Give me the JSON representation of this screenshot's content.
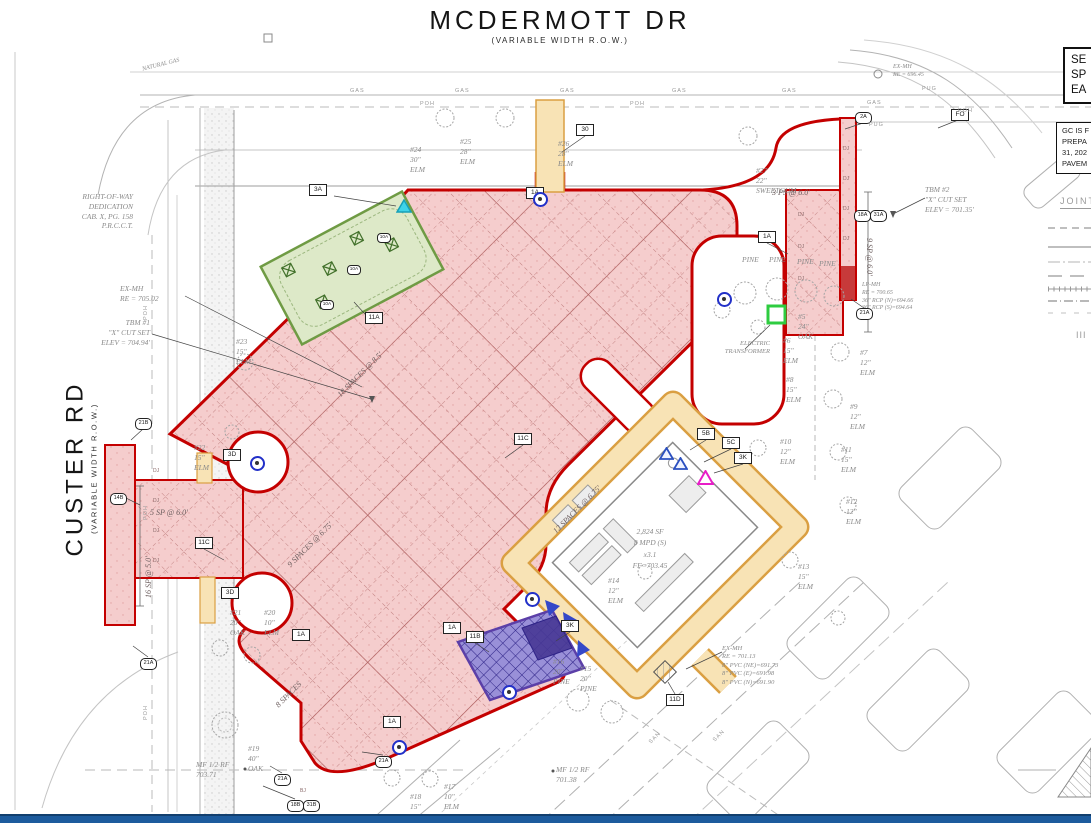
{
  "roads": {
    "top_name": "MCDERMOTT DR",
    "top_row": "(VARIABLE WIDTH R.O.W.)",
    "left_name": "CUSTER RD",
    "left_row": "(VARIABLE WIDTH R.O.W.)"
  },
  "panel": {
    "box1": "SE\nSP\nEA",
    "box2": "GC IS F\nPREPA\n31, 202\nPAVEM",
    "joint": "JOINT",
    "bars": "III"
  },
  "building": {
    "text": "2,824 SF\n8 MPD (S)\nx3.1\nFF=703.45"
  },
  "trees": {
    "t5": "#5\n24\"\nOAK",
    "t6": "#6\n15\"\nELM",
    "t7": "#7\n12\"\nELM",
    "t8": "#8\n15\"\nELM",
    "t9": "#9\n12\"\nELM",
    "t10": "#10\n12\"\nELM",
    "t11": "#11\n15\"\nELM",
    "t12": "#12\n12\"\nELM",
    "t13": "#13\n15\"\nELM",
    "t14": "#14\n12\"\nELM",
    "t15": "#15\n20\"\nPINE",
    "t16": "#16\n20\"\nPINE",
    "t17": "#17\n10\"\nELM",
    "t18": "#18\n15\"\nELM",
    "t19": "#19\n40\"\nOAK",
    "t20": "#20\n10\"\nELM",
    "t21": "#21\n20\"\nOAK",
    "t22": "#22\n15\"\nELM",
    "t23": "#23\n15\"\nELM",
    "t24": "#24\n30\"\nELM",
    "t25": "#25\n28\"\nELM",
    "t26": "#26\n28\"\nELM",
    "t27": "#27\n22\"\nSWEETGUM",
    "pine": "PINE"
  },
  "parking": {
    "ps3": "3 PS @ 6.0'",
    "sp9": "9 SP @ 6.0'",
    "sp5": "5 SP @ 6.0'",
    "sp16": "16 SP @ 5.0'",
    "spaces18": "18 SPACES @ 8.5'",
    "spaces12": "12 SPACES @ 6.75'",
    "spaces9": "9 SPACES @ 6.75'",
    "spaces8": "8 SPACES"
  },
  "keynotes": {
    "k30": "30",
    "k1A": "1A",
    "k3A": "3A",
    "k3D": "3D",
    "k5B": "5B",
    "k5C": "5C",
    "k3K": "3K",
    "k11A": "11A",
    "k11B": "11B",
    "k11C": "11C",
    "k11D": "11D",
    "kFO": "FO"
  },
  "hexes": {
    "h2A": "2A",
    "h21A": "21A",
    "h21B": "21B",
    "h14B": "14B",
    "h18A": "18A",
    "h31A": "31A",
    "h18B": "18B",
    "h31B": "31B",
    "h10A": "10A"
  },
  "ann": {
    "row_dedication": "RIGHT-OF-WAY\nDEDICATION\nCAB. X, PG. 158\nP.R.C.C.T.",
    "ex_mh_custer": "EX-MH\nRE = 705.02",
    "tbm1": "TBM #1\n\"X\" CUT SET\nELEV = 704.94'",
    "tbm2": "TBM #2\n\"X\" CUT SET\nELEV = 701.35'",
    "ex_mh_south": "EX-MH\nRE = 701.13\n8\" PVC (NE)=691.73\n8\" PVC (E)=691.98\n8\" PVC (N)=691.90",
    "lp_mh": "LP-MH\nRE = 700.65\n36\" RCP (N)=694.66\n36\" RCP (S)=694.64",
    "mf_west": "MF 1/2 RF\n703.71",
    "mf_south": "MF 1/2 RF\n701.38",
    "natural_gas": "NATURAL GAS",
    "transformer": "ELECTRIC\nTRANSFORMER",
    "ex_mh_ne": "EX-MH\nRE = 696.45"
  },
  "util": {
    "gas": "GAS",
    "poh": "POH",
    "pug": "PUG",
    "san": "SAN",
    "dj": "DJ",
    "bj": "BJ"
  },
  "colors": {
    "accent_red": "#c40000",
    "pavement_pink": "#f5cdcd",
    "sidewalk_orange": "#f8e3b5",
    "landscape_green": "#dde9c8",
    "enclosure_purple": "#9990d8",
    "transformer_green": "#2ecc40",
    "marker_blue": "#2230c8",
    "bottom_bar_blue": "#1d5b9d"
  }
}
